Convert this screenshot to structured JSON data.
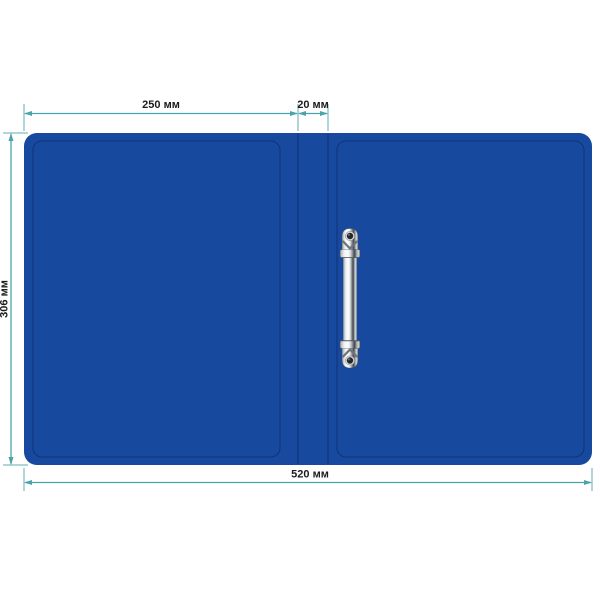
{
  "page": {
    "background_color": "#ffffff",
    "description": "Technical dimension diagram of a blue plastic ring-binder folder shown unfolded flat, with metal 2-ring mechanism"
  },
  "diagram": {
    "units": "мм",
    "dimensions": {
      "front_cover_width": {
        "label": "250 мм",
        "value": 250
      },
      "spine_width": {
        "label": "20 мм",
        "value": 20
      },
      "height": {
        "label": "306 мм",
        "value": 306
      },
      "total_width": {
        "label": "520 мм",
        "value": 520
      }
    },
    "colors": {
      "binder_blue": "#17499e",
      "crease_blue": "#0f3573",
      "dimension_teal": "#4aa3ab",
      "label_text": "#1c1c1c",
      "metal_light": "#fdfefe",
      "metal_mid": "#9aa0a6",
      "metal_dark": "#454a50",
      "background": "#ffffff"
    }
  }
}
